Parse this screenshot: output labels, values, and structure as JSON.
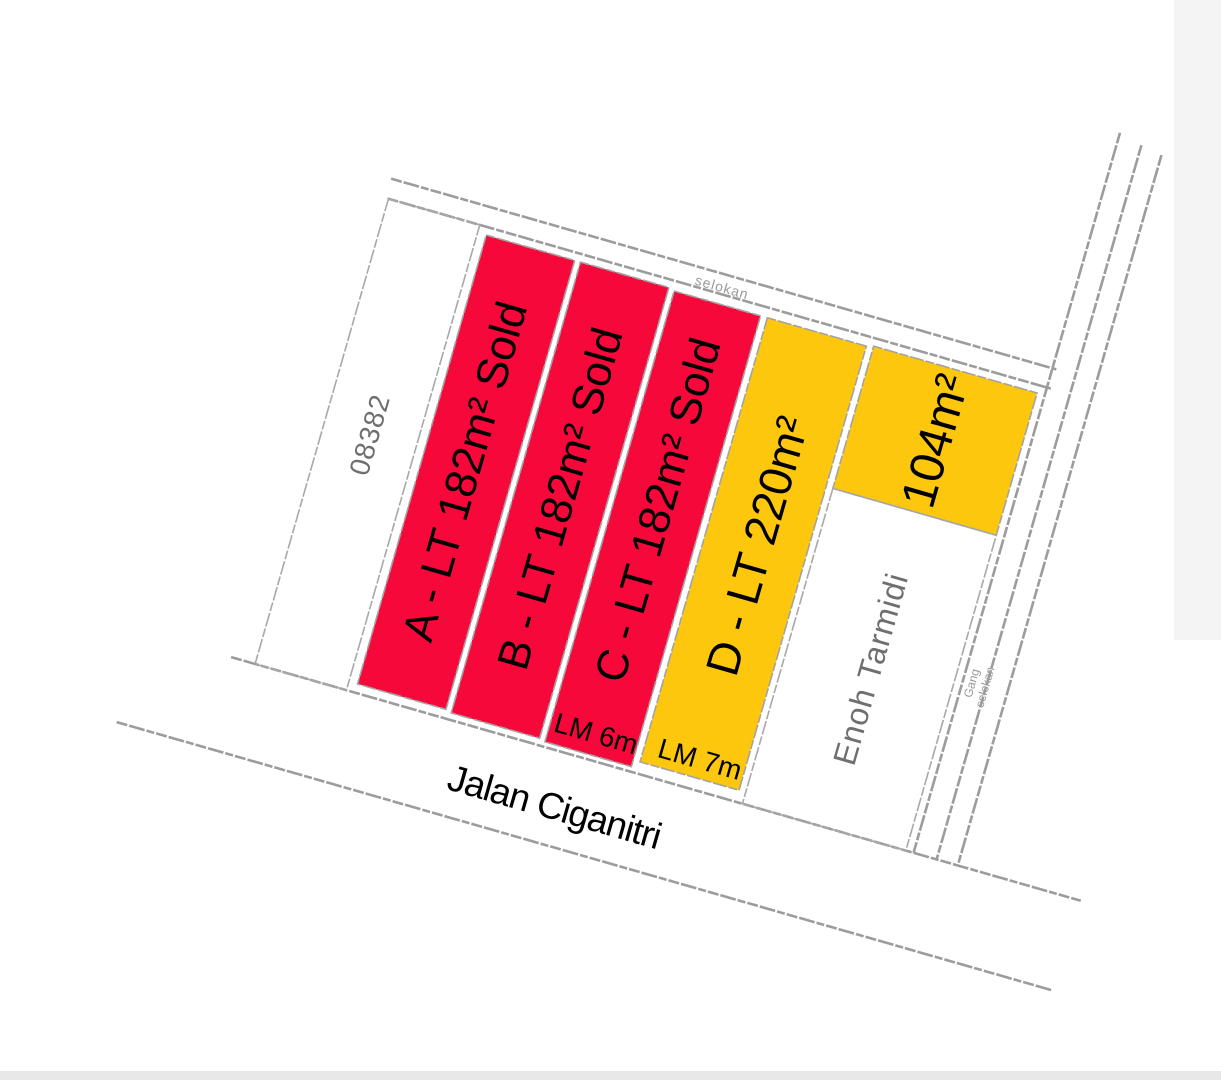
{
  "map": {
    "rotation_deg": 16,
    "colors": {
      "sold": "#f6093a",
      "available": "#fcc70d",
      "line_gray": "#9c9c9c",
      "label_gray": "#6f6f6f"
    },
    "roads": {
      "main": "Jalan Ciganitri",
      "top_boundary": "selokan",
      "side_lane": [
        "Gang",
        "selokan"
      ]
    },
    "plots": {
      "reference": {
        "label": "08382"
      },
      "a": {
        "label": "A - LT 182m² Sold",
        "status": "sold"
      },
      "b": {
        "label": "B - LT 182m² Sold",
        "status": "sold"
      },
      "c": {
        "label": "C - LT 182m² Sold",
        "status": "sold",
        "frontage": "LM 6m"
      },
      "d": {
        "label": "D - LT 220m²",
        "status": "available",
        "frontage": "LM 7m"
      },
      "e": {
        "label": "104m²",
        "status": "available"
      },
      "neighbor": {
        "label": "Enoh Tarmidi"
      }
    }
  }
}
